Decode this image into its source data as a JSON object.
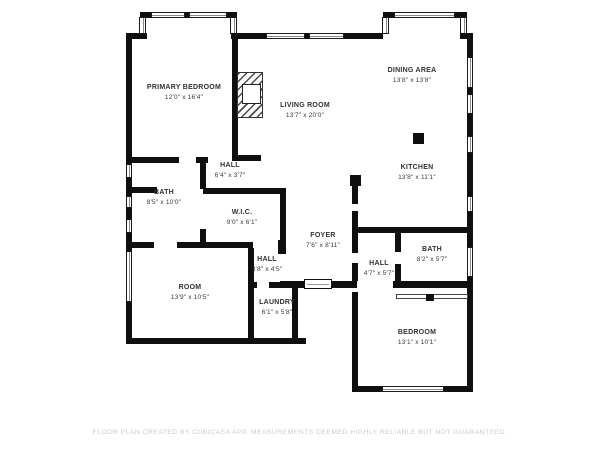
{
  "plan": {
    "rooms": [
      {
        "name": "PRIMARY BEDROOM",
        "dims": "12'0\" x 16'4\""
      },
      {
        "name": "LIVING ROOM",
        "dims": "13'7\" x 20'0\""
      },
      {
        "name": "DINING AREA",
        "dims": "13'8\" x 13'8\""
      },
      {
        "name": "KITCHEN",
        "dims": "13'8\" x 11'1\""
      },
      {
        "name": "HALL",
        "dims": "6'4\" x 3'7\""
      },
      {
        "name": "BATH",
        "dims": "8'5\" x 10'0\""
      },
      {
        "name": "W.I.C.",
        "dims": "9'0\" x 6'1\""
      },
      {
        "name": "FOYER",
        "dims": "7'6\" x 8'11\""
      },
      {
        "name": "HALL",
        "dims": "4'7\" x 5'7\""
      },
      {
        "name": "BATH",
        "dims": "8'2\" x 5'7\""
      },
      {
        "name": "HALL",
        "dims": "3'8\" x 4'5\""
      },
      {
        "name": "ROOM",
        "dims": "13'9\" x 10'5\""
      },
      {
        "name": "LAUNDRY",
        "dims": "6'1\" x 5'8\""
      },
      {
        "name": "BEDROOM",
        "dims": "13'1\" x 10'1\""
      }
    ],
    "footer": "FLOOR PLAN CREATED BY CUBICASA APP. MEASUREMENTS DEEMED HIGHLY RELIABLE BUT NOT GUARANTEED.",
    "colors": {
      "wall": "#0f0f0f",
      "background": "#ffffff",
      "label": "#313131",
      "disclaimer": "#cbcbcb"
    }
  }
}
